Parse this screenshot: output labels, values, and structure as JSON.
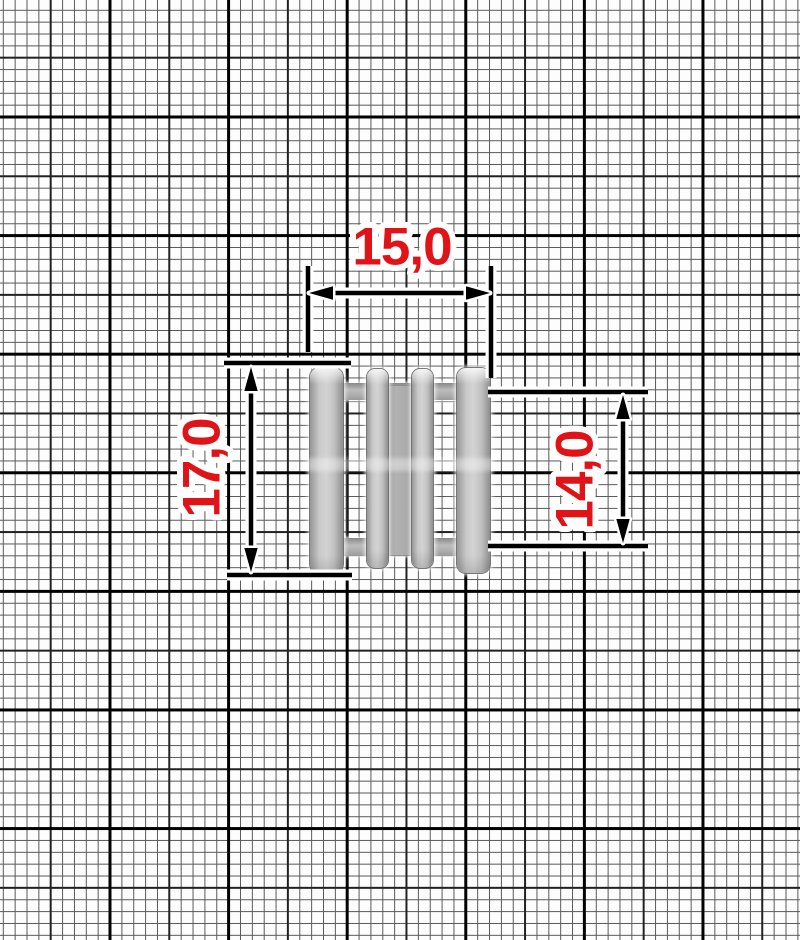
{
  "diagram": {
    "subject": "metal-four-bar-strap-adjuster-buckle",
    "background": "millimeter-graph-paper",
    "dimension_labels": {
      "top_width": "15,0",
      "left_height": "17,0",
      "right_height": "14,0"
    },
    "colors": {
      "dimension_text": "#e01418",
      "dimension_lines": "#000000",
      "halo": "#ffffff",
      "metal_base": "#c0c0c0",
      "grid_bold": "#000000",
      "grid_thin": "#585858"
    }
  }
}
